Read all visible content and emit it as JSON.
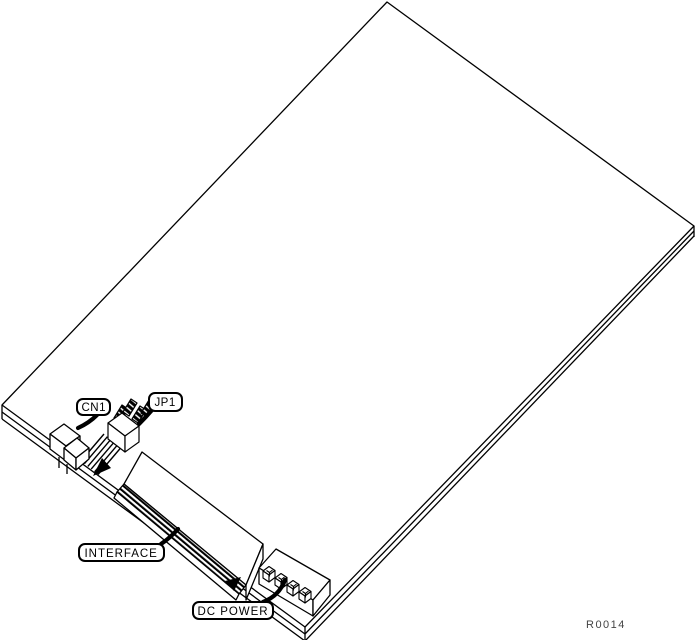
{
  "figure": {
    "kind": "isometric-circuit-board-line-drawing"
  },
  "callouts": {
    "cn1": "CN1",
    "jp1": "JP1",
    "interface": "INTERFACE",
    "dc_power": "DC POWER"
  },
  "reference": "R0014",
  "colors": {
    "ink": "#000000",
    "paper": "#ffffff",
    "reference_text": "#444444"
  }
}
